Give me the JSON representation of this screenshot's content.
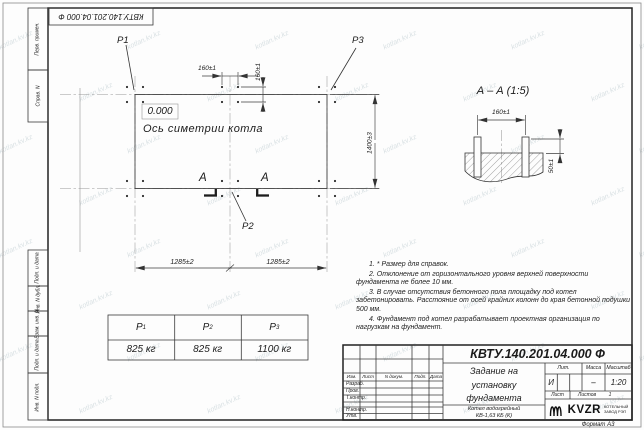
{
  "sheet": {
    "doc_number": "КВТУ.140.201.04.000  Ф",
    "format_label": "Формат А3"
  },
  "margin": {
    "labels": [
      "Перв. примен.",
      "Справ. N",
      "Подп. и дата",
      "Инв. N дубл.",
      "Взам. инв. N",
      "Подп. и дата",
      "Инв. N подл."
    ]
  },
  "plan": {
    "load_p1": "Р1",
    "load_p2": "Р2",
    "load_p3": "Р3",
    "elevation": "0.000",
    "axis_label": "Ось симетрии котла",
    "dims": {
      "bolt_h": "160±1",
      "bolt_v": "160±1",
      "height_total": "1400±3",
      "span_left": "1285±2",
      "span_right": "1285±2"
    },
    "section_letter_left": "А",
    "section_letter_right": "А"
  },
  "section_view": {
    "title": "А – А  (1:5)",
    "dim_bolt": "160±1",
    "dim_height": "50±1"
  },
  "notes": [
    "1.  * Размер для справок.",
    "2.  Отклонение от горизонтального уровня верхней поверхности фундамента не более 10 мм.",
    "3.  В случае отсутствия бетонного пола площадку под котел забетонировать. Расстояние от осей крайних колонн до края бетонной подушки 500 мм.",
    "4.  Фундамент под котел разрабатывает проектная организация по нагрузкам на фундамент."
  ],
  "load_table": {
    "headers": [
      {
        "base": "Р",
        "sub": "1"
      },
      {
        "base": "Р",
        "sub": "2"
      },
      {
        "base": "Р",
        "sub": "3"
      }
    ],
    "values": [
      "825 кг",
      "825 кг",
      "1100 кг"
    ]
  },
  "title_block": {
    "doc_number": "КВТУ.140.201.04.000  Ф",
    "title_line1": "Задание на",
    "title_line2": "установку",
    "title_line3": "фундамента",
    "product_line1": "Котел водогрейный",
    "product_line2": "КВ-1,63 КБ  (К)",
    "col_izm": "Изм.",
    "col_list": "Лист",
    "col_doc": "N докум.",
    "col_sign": "Подп.",
    "col_date": "Дата",
    "row_razrab": "Разраб.",
    "row_prov": "Пров.",
    "row_tkontr": "Т.контр.",
    "row_nkontr": "Н.контр.",
    "row_utv": "Утв.",
    "lit_label": "Лит.",
    "mass_label": "Масса",
    "scale_label": "Масштаб",
    "lit_value": "И",
    "mass_value": "–",
    "scale_value": "1:20",
    "sheet_label": "Лист",
    "sheets_label": "Листов",
    "sheets_value": "1",
    "logo_text": "KVZR",
    "logo_sub1": "КОТЕЛЬНЫЙ",
    "logo_sub2": "ЗАВОД РЭП"
  },
  "watermark": "kotlan.kv.kz"
}
